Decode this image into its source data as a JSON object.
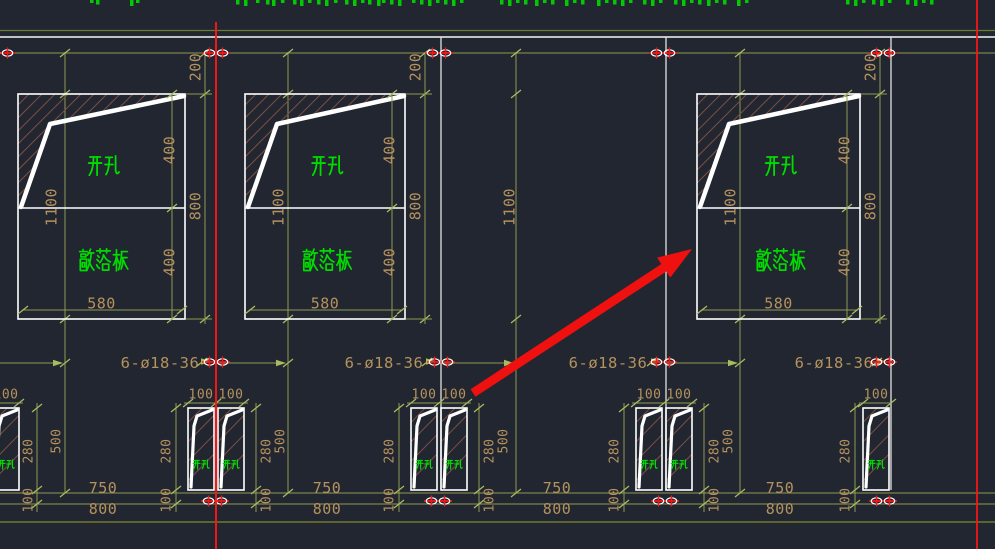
{
  "app": {
    "type": "CAD drawing viewport",
    "description": "Precast wall panel elevation with knockout openings, small paired openings and rebar callouts"
  },
  "colors": {
    "background": "#212630",
    "drawing_white": "#ffffff",
    "joint_white": "#e9e9e9",
    "dim_line": "#8e9b52",
    "dim_line_dark": "#6f7a2c",
    "dim_tick": "#a9bb5e",
    "dim_text": "#b5925e",
    "cjk_green": "#00dc00",
    "hatch_brown": "#7d4f44",
    "highlight_red": "#ff1515",
    "arrow_red": "#ef1010"
  },
  "panels": [
    {
      "open_hole": "开孔",
      "knockout": "敲落板",
      "dim_top": "200",
      "dim_upper": "400",
      "dim_lower": "400",
      "dim_left": "1100",
      "dim_right": "800",
      "dim_width": "580"
    },
    {
      "open_hole": "开孔",
      "knockout": "敲落板",
      "dim_top": "200",
      "dim_upper": "400",
      "dim_lower": "400",
      "dim_left": "1100",
      "dim_right": "800",
      "dim_width": "580"
    },
    {
      "open_hole": "开孔",
      "knockout": "敲落板",
      "dim_top": "200",
      "dim_upper": "400",
      "dim_lower": "400",
      "dim_left": "1100",
      "dim_right": "800",
      "dim_width": "580"
    }
  ],
  "middle_segment": {
    "dim_left": "1100"
  },
  "rebar_notes": [
    "6-ø18-36",
    "6-ø18-36",
    "6-ø18-36",
    "6-ø18-36"
  ],
  "small_openings": [
    {
      "open_hole": "开孔",
      "dims_top": [
        "100"
      ],
      "dims_side": [
        "280"
      ],
      "dims_bottom": [
        "100"
      ],
      "dim_total": "500"
    },
    {
      "open_hole": "开孔",
      "dims_top": [
        "100",
        "100"
      ],
      "dims_side": [
        "280",
        "280"
      ],
      "dims_bottom": [
        "100",
        "100"
      ],
      "dim_total": "500"
    },
    {
      "open_hole": "开孔",
      "dims_top": [
        "100",
        "100"
      ],
      "dims_side": [
        "280",
        "280"
      ],
      "dims_bottom": [
        "100",
        "100"
      ],
      "dim_total": "500"
    },
    {
      "open_hole": "开孔",
      "dims_top": [
        "100",
        "100"
      ],
      "dims_side": [
        "280",
        "280"
      ],
      "dims_bottom": [
        "100",
        "100"
      ],
      "dim_total": "500"
    },
    {
      "open_hole": "开孔",
      "dims_top": [
        "100"
      ],
      "dims_side": [
        "280"
      ],
      "dims_bottom": [
        "100"
      ]
    }
  ],
  "bottom_dims": [
    {
      "row1": "750",
      "row2": "800"
    },
    {
      "row1": "750",
      "row2": "800"
    },
    {
      "row1": "750",
      "row2": "800"
    },
    {
      "row1": "750",
      "row2": "800"
    }
  ],
  "top_edge_text_fragments": {
    "description": "cut-off green annotation text along top edge",
    "xs": [
      90,
      96,
      130,
      136,
      236,
      244,
      256,
      266,
      272,
      281,
      293,
      300,
      308,
      317,
      325,
      334,
      345,
      353,
      361,
      368,
      377,
      382,
      390,
      398,
      412,
      420,
      428,
      436,
      444,
      452,
      460,
      500,
      508,
      516,
      524,
      535,
      543,
      551,
      565,
      573,
      581,
      597,
      605,
      613,
      621,
      629,
      643,
      651,
      659,
      674,
      682,
      690,
      698,
      707,
      715,
      723,
      737,
      745,
      846,
      854,
      862,
      872,
      880,
      888,
      906,
      914,
      922,
      930
    ]
  }
}
